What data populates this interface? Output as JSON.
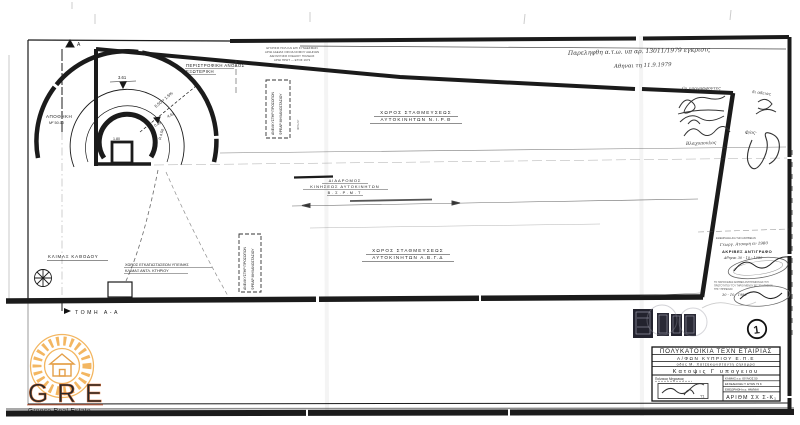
{
  "plan": {
    "section_marker": "Α",
    "section_label": "ΤΟΜΗ  Α-Α",
    "storage_name": "ΑΠΟΘΗΚΗ",
    "storage_area": "Μ² 50.00",
    "ramp_line1": "ΠΕΡΙΣΤΡΟΦΙΚΗ ΑΝΟΔΟΣ",
    "ramp_line2": "ΕΞΩΤΕΡΙΚΗ",
    "dim_361": "3.61",
    "dim_550": "5.50 + 1.5%",
    "dim_461": "4.61",
    "dim_045": "0.45",
    "dim_r450": "R 4.50",
    "dim_180": "1.80",
    "note_line1": "ΕΓΚΡΙΣΙΣ ΠΟΛ ΚΑΙ ΕΠΙ ΣΥΝΔΕΣΜΩΝ",
    "note_line2": "ΑΡΙΘ ΑΔΕΙΑΣ ΟΙΚΟΔ ΝΟΜΟΥ ΑΘΗΝΩΝ",
    "note_line3": "ΔΙΕΥΘΥΝΣΙΣ ΣΧΕΔΙΟΥ ΠΟΛΕΩΣ",
    "note_line4": "ΑΡΙΘ ΠΡΩΤ — ΕΤΟΣ 1973",
    "shaft1_text1": "ΑΝΕΛΚΥΣΤΗΡ ΠΡΟΣΩΠΩΝ",
    "shaft1_text2": "ΦΡΕΑΡ ΜΗΧΑΝΟΣΤΑΣΙΟΥ",
    "shaft1_side": "ΦΡΕΑΡ",
    "shaft2_text1": "ΑΝΕΛΚΥΣΤΗΡ ΠΡΟΣΩΠΩΝ",
    "shaft2_text2": "ΦΡΕΑΡ ΜΗΧΑΝΟΣΤΑΣΙΟΥ",
    "parking_a1": "ΧΩΡΟΣ  ΣΤΑΘΜΕΥΣΕΩΣ",
    "parking_a2": "ΑΥΤΟΚΙΝΗΤΩΝ    Ν.Ι.Ρ.Θ",
    "corridor1": "ΔΙΑΔΡΟΜΟΣ",
    "corridor2": "ΚΙΝΗΣΕΩΣ  ΑΥΤΟΚΙΝΗΤΩΝ",
    "corridor3": "Β.Σ.Ρ.Μ.Τ",
    "parking_b1": "ΧΩΡΟΣ  ΣΤΑΘΜΕΥΣΕΩΣ",
    "parking_b2": "ΑΥΤΟΚΙΝΗΤΩΝ    Α.Β.Γ.Δ",
    "stair_label": "ΚΛΙΜΑΞ ΚΑΘΟΔΟΥ",
    "wc_line1": "ΧΩΡΟΣ ΕΓΚΑΤΑΣΤΑΣΕΩΝ ΥΓΙΕΙΝΗΣ",
    "wc_line2": "ΚΛΙΜΑΞ ΑΝΤΛ. ΚΤΗΡΙΟΥ"
  },
  "handwriting": {
    "received": "Παρεληφθη α.τ.ω. υπ αρ. 13011/1979 εγκρισις",
    "date": "Αθηναι τη 11.9.1979",
    "signers": "Οι υπογραφοντες",
    "name": "Βλαχοπουλος",
    "margin1": "δι αδειας",
    "margin2": "Φ/ος·"
  },
  "copy_stamp": {
    "head_note": "ΕΘΕΩΡΗΘΗ ΔΙΑ ΤΗΝ ΑΚΡΙΒΕΙΑΝ",
    "hand_name": "Γεωργ. Ατσαρη εν 1980",
    "certify": "ΑΚΡΙΒΕΣ ΑΝΤΙΓΡΑΦΟ",
    "date1": "Αθηναι 30 - 10 - 1980",
    "fine1": "ΤΟ ΠΑΡΟΝ ΕΙΝΑΙ ΑΚΡΙΒΕΣ ΑΝΤΙΓΡΑΦΟΝ ΕΚ ΤΟΥ",
    "fine2": "ΠΡΩΤΟΤΥΠΟΥ ΤΟΥ ΤΗΡΟΥΜΕΝΟΥ ΕΙΣ ΤΟ ΑΡΧΕΙΟΝ",
    "fine3": "ΤΗΣ ΥΠΗΡΕΣΙΑΣ",
    "date2": "30 - 10 - 1980"
  },
  "title_block": {
    "row1": "ΠΟΛΥΚΑΤΟΙΚΙΑ ΤΕΧΝ ΕΤΑΙΡΙΑΣ",
    "row2": "Α/ΦΩΝ   ΚΥΠΡΙΟΥ   Ε.Π.Ε",
    "row3": "οδος Μ. Χατζηκωνσταντη ζηλαμρα",
    "row4": "Κατοψις  Γ  υπογειου",
    "engineer_label": "Πολιτικος Μηχανικος",
    "engineer_year": "'71",
    "info1": "ΚΛΙΜΑΞ ε.α. ΙΟΥΛΙΟΣ 50",
    "info2": "ΕΣΧΕΔΙΑΣΘΗ Τ. ΕΤΩΝ 73 Κ",
    "info3": "ΕΘΕΩΡΗΘΗ κ.α. ΗΜ/ΝΙΑΙ",
    "number_label": "ΑΡΙΘΜ ΣΧ Σ-Κ₁",
    "sheet_no": "1"
  },
  "logo": {
    "text": "GRE",
    "subtext": "Greece Real Estate",
    "orange": "#f0a952"
  }
}
